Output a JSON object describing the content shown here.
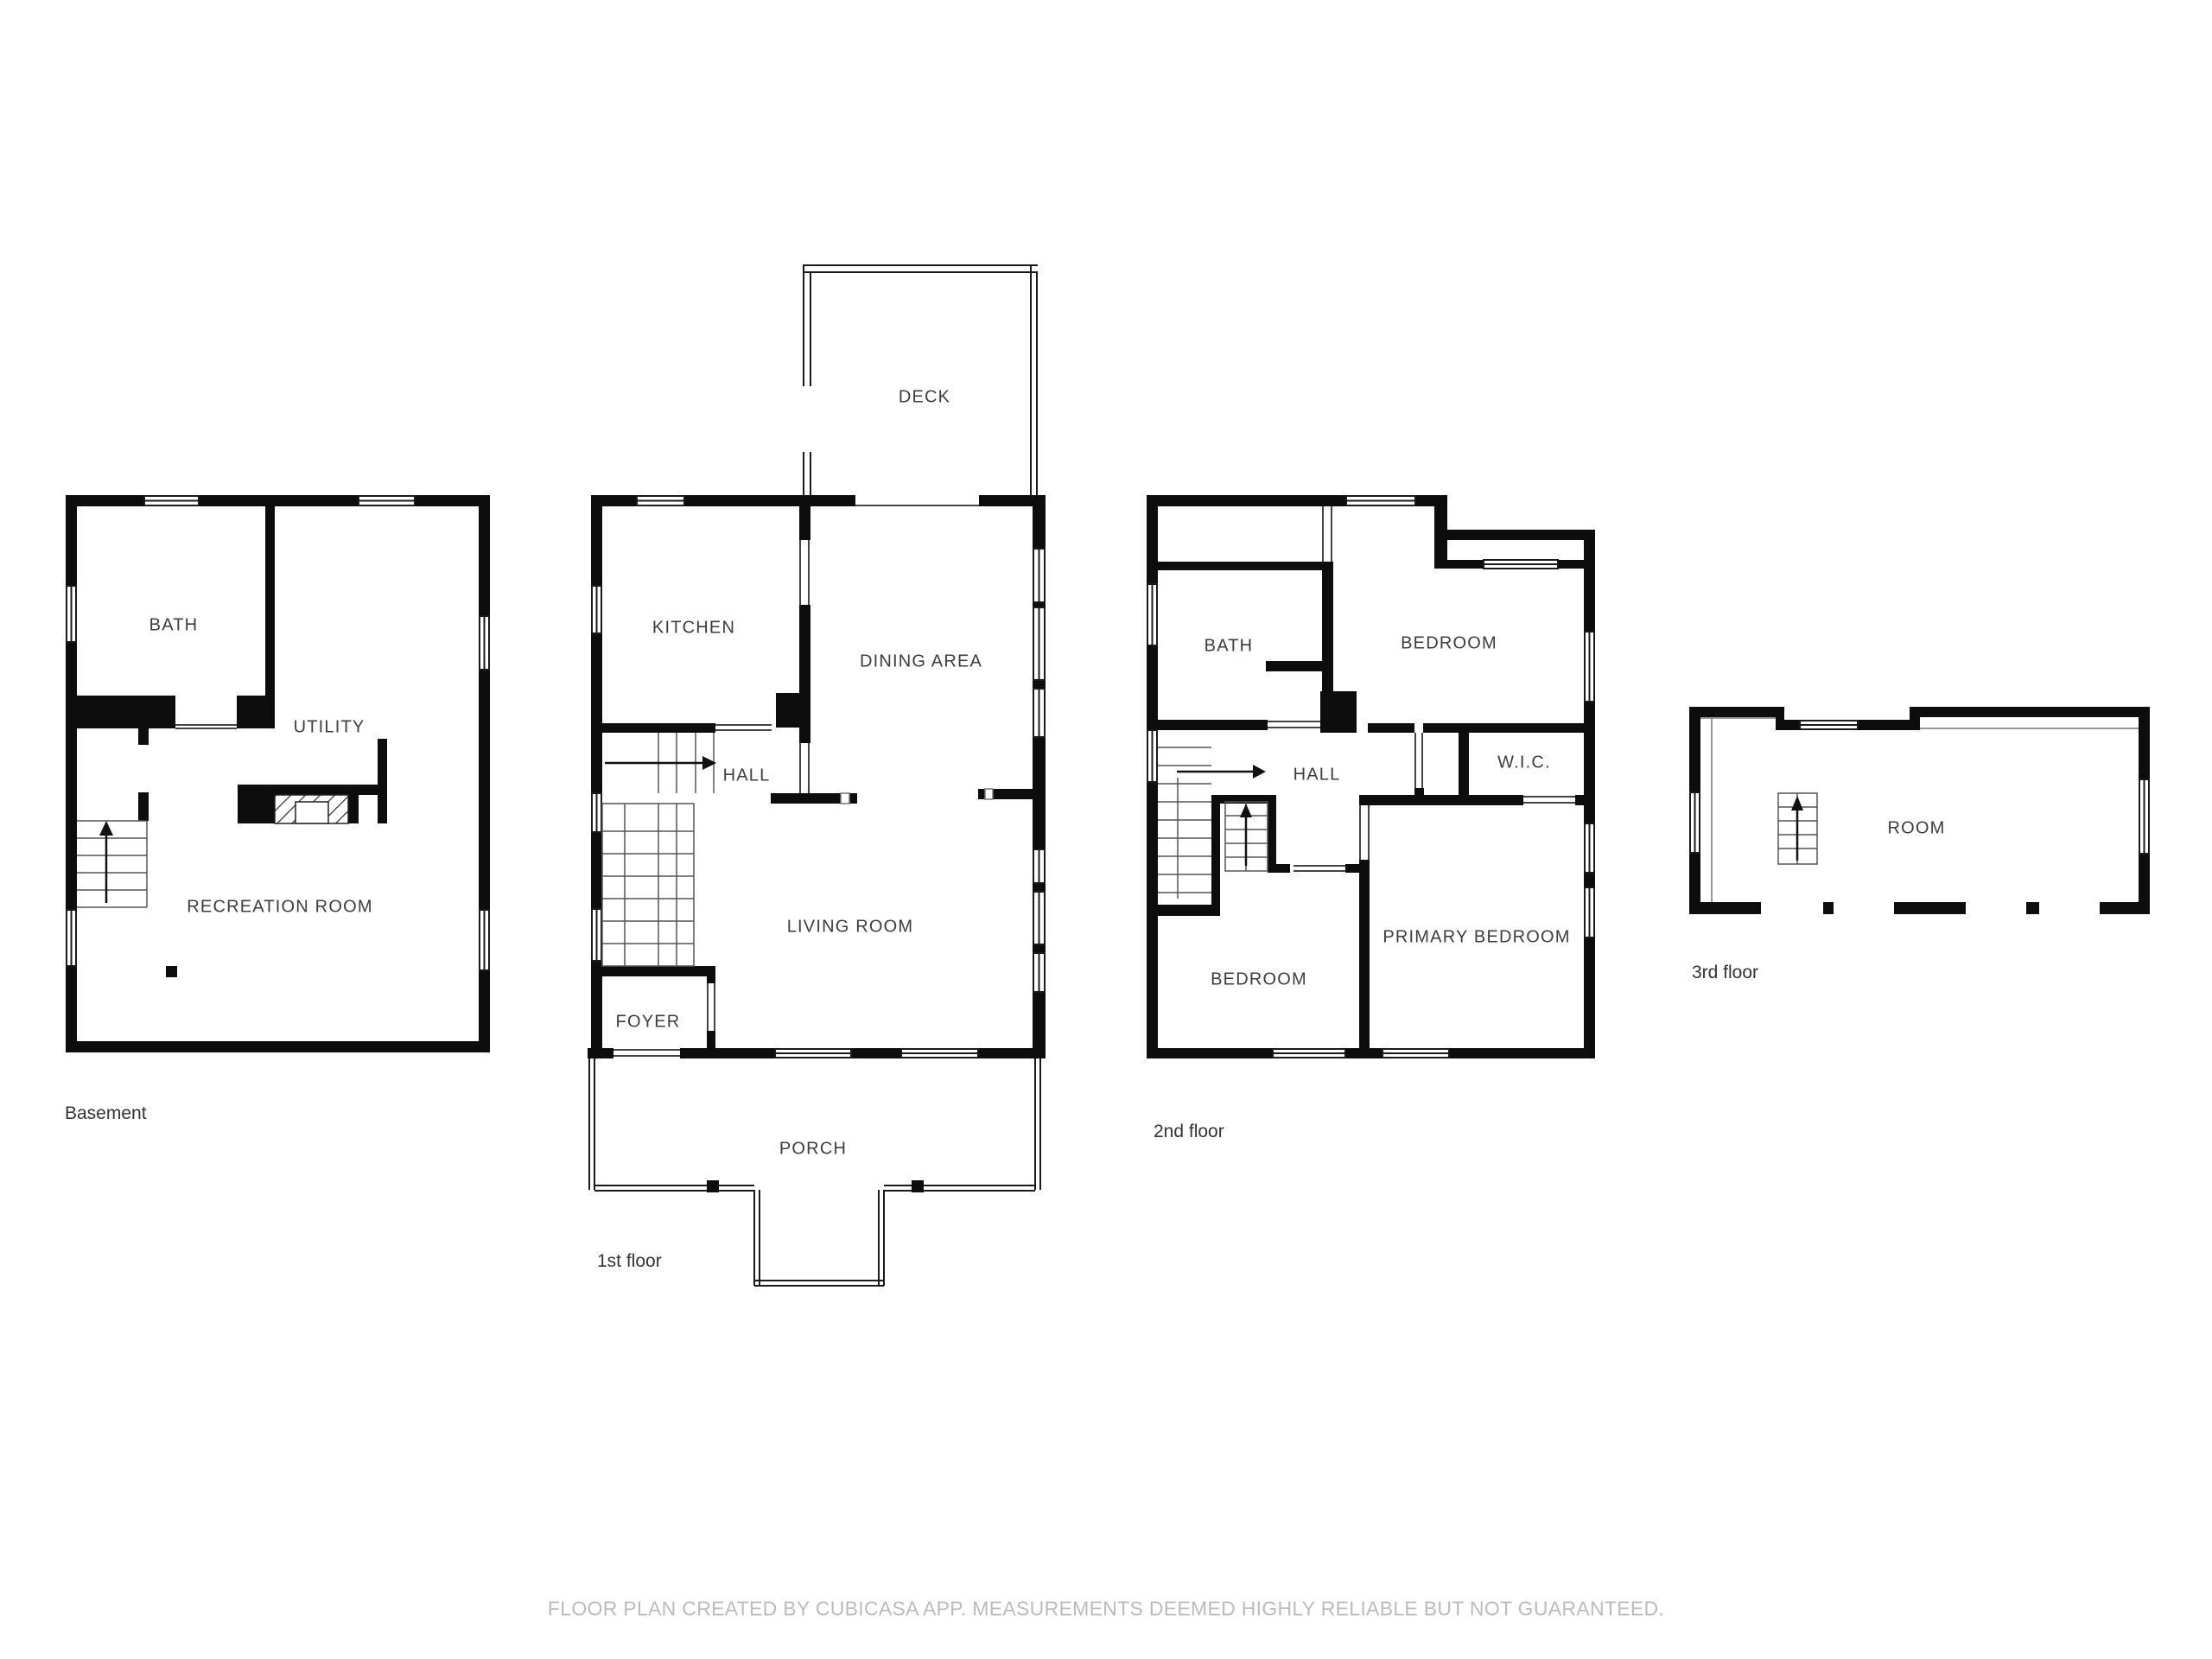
{
  "disclaimer": "FLOOR PLAN CREATED BY CUBICASA APP. MEASUREMENTS DEEMED HIGHLY RELIABLE BUT NOT GUARANTEED.",
  "colors": {
    "wall": "#0d0d0d",
    "thin_line": "#1a1a1a",
    "stair_line": "#555555",
    "label_text": "#3d3d3d",
    "caption_text": "#333333",
    "disclaimer_text": "#bcbcbc",
    "background": "#ffffff"
  },
  "floors": [
    {
      "name": "basement",
      "caption": "Basement",
      "rooms": [
        {
          "label": "BATH"
        },
        {
          "label": "UTILITY"
        },
        {
          "label": "RECREATION ROOM"
        }
      ]
    },
    {
      "name": "first-floor",
      "caption": "1st floor",
      "rooms": [
        {
          "label": "DECK"
        },
        {
          "label": "KITCHEN"
        },
        {
          "label": "DINING AREA"
        },
        {
          "label": "HALL"
        },
        {
          "label": "LIVING ROOM"
        },
        {
          "label": "FOYER"
        },
        {
          "label": "PORCH"
        }
      ]
    },
    {
      "name": "second-floor",
      "caption": "2nd floor",
      "rooms": [
        {
          "label": "BATH"
        },
        {
          "label": "BEDROOM"
        },
        {
          "label": "HALL"
        },
        {
          "label": "W.I.C."
        },
        {
          "label": "PRIMARY BEDROOM"
        },
        {
          "label": "BEDROOM"
        }
      ]
    },
    {
      "name": "third-floor",
      "caption": "3rd floor",
      "rooms": [
        {
          "label": "ROOM"
        }
      ]
    }
  ]
}
